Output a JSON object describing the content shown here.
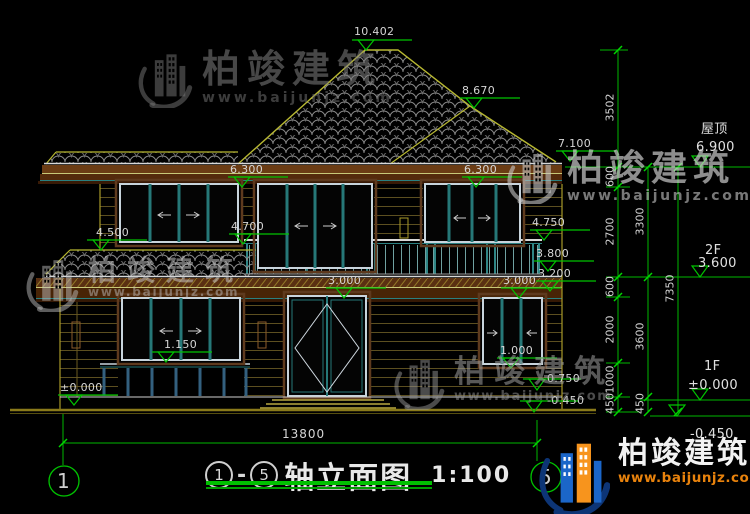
{
  "watermark": {
    "brand": "柏竣建筑",
    "url": "www.baijunjz.com"
  },
  "levels": {
    "ridge": "10.402",
    "hip_peak": "8.670",
    "eave_right": "7.100",
    "win2_head_left": "6.300",
    "win2_head_right": "6.300",
    "pent_eave": "4.500",
    "rail_top": "4.700",
    "rail_top_right": "4.750",
    "slab_top": "3.800",
    "slab_bottom": "3.200",
    "win1_head_left": "3.000",
    "win1_head_right": "3.000",
    "sill_left": "1.150",
    "sill_right": "1.000",
    "floor": "±0.000",
    "porch": "0.750",
    "below_grade": "-0.450"
  },
  "right_levels": {
    "roof_label": "屋顶",
    "roof_value": "6.900",
    "f2_label": "2F",
    "f2_value": "3.600",
    "f1_label": "1F",
    "f1_value": "±0.000",
    "grade_value": "-0.450"
  },
  "chain_a": {
    "s1": "3502",
    "s2": "600",
    "s3": "2700",
    "s4": "600",
    "s5": "2000",
    "s6": "1000",
    "s7": "450"
  },
  "chain_b": {
    "s1": "3300",
    "s2": "3600",
    "s3": "450"
  },
  "chain_c": {
    "s1": "7350"
  },
  "footer": {
    "width_dim": "13800",
    "axis_left": "1",
    "axis_right": "5",
    "title_axis_from": "1",
    "title_axis_dash": "-",
    "title_axis_to": "5",
    "title_text": "轴立面图",
    "title_scale": "1:100"
  },
  "colors": {
    "dimension_green": "#00b800",
    "outline_yellow": "#b8b832",
    "window_teal": "#267878",
    "trim_brown": "#6b3c14",
    "logo_blue": "#1b66c9",
    "logo_orange": "#f7941d",
    "url_orange": "#e8820c"
  }
}
